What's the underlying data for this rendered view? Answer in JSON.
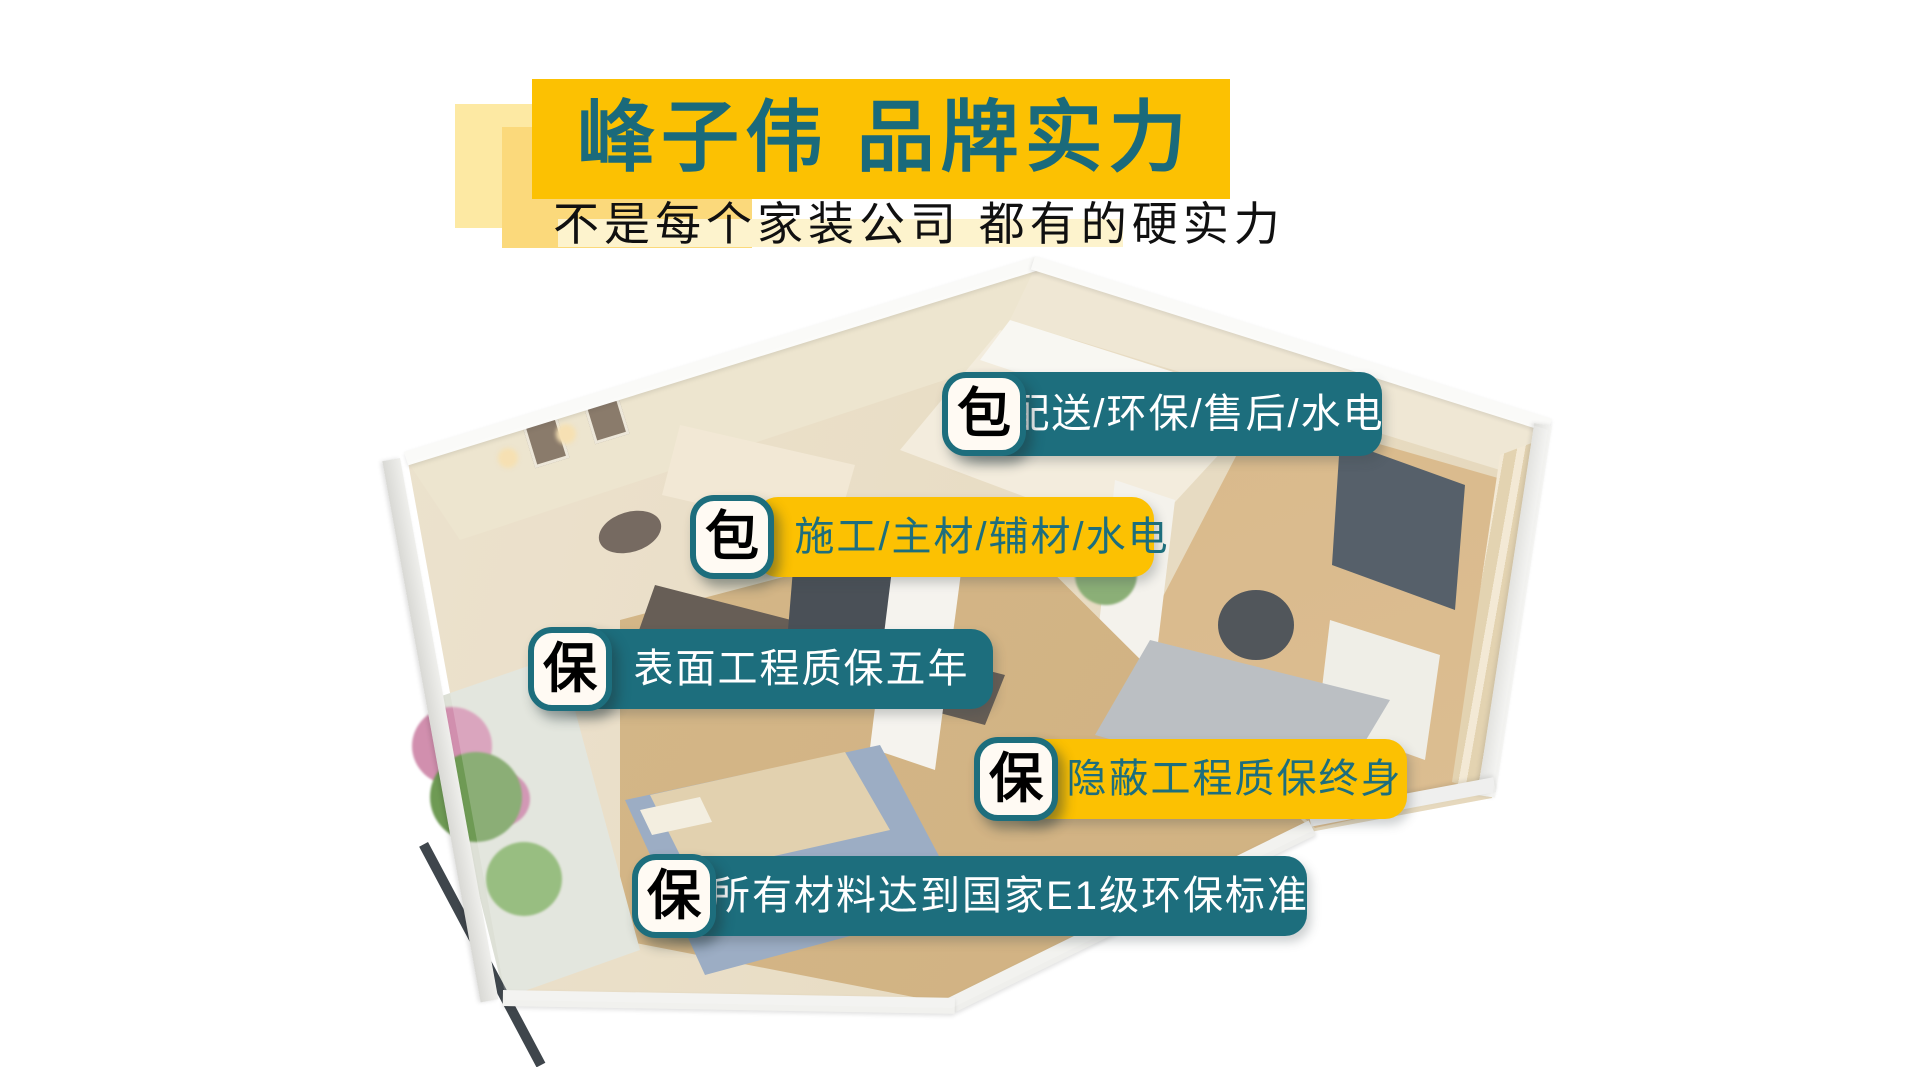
{
  "poster": {
    "title": "峰子伟 品牌实力",
    "subtitle": "不是每个家装公司 都有的硬实力"
  },
  "pills": [
    {
      "badge": "包",
      "label": "配送/环保/售后/水电",
      "variant": "teal"
    },
    {
      "badge": "包",
      "label": "施工/主材/辅材/水电",
      "variant": "yellow"
    },
    {
      "badge": "保",
      "label": "表面工程质保五年",
      "variant": "teal"
    },
    {
      "badge": "保",
      "label": "隐蔽工程质保终身",
      "variant": "yellow"
    },
    {
      "badge": "保",
      "label": "所有材料达到国家E1级环保标准",
      "variant": "teal"
    }
  ],
  "colors": {
    "teal": "#1d6e7d",
    "yellow": "#fcc102",
    "title_text": "#1a6a7b",
    "subtitle_text": "#101010",
    "pill_text_light": "#ffffff",
    "badge_text": "#000000",
    "badge_background": "#fffaf3",
    "underlay_light": "#fde9a3",
    "underlay_medium": "#fbd97b",
    "subtitle_band": "#fdf3cd"
  },
  "background": {
    "art": "isometric-apartment-floorplan"
  }
}
